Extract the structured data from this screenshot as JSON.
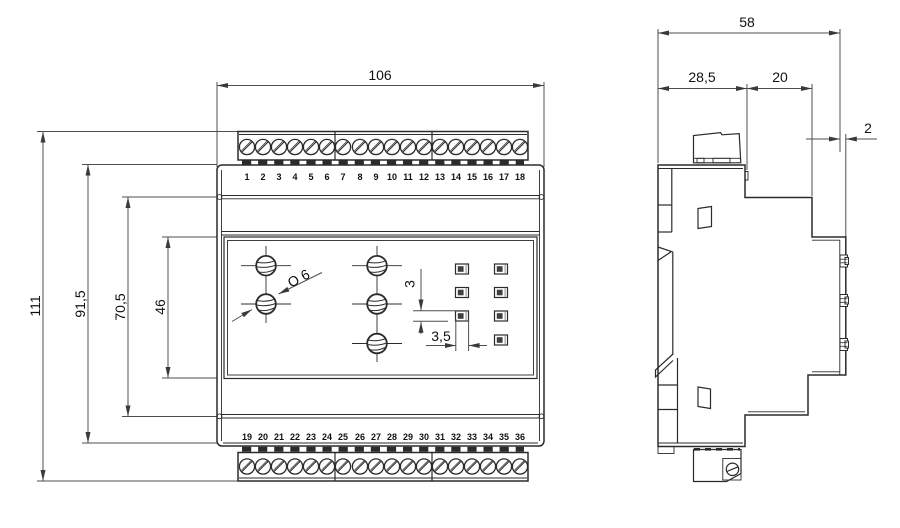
{
  "drawing": {
    "front_view": {
      "width_label": "106",
      "height_labels": {
        "overall": "111",
        "body": "91,5",
        "section": "70,5",
        "panel": "46"
      },
      "annotations": {
        "hole_diameter": "O 6",
        "led_height": "3",
        "led_width": "3,5"
      },
      "top_terminals": [
        "1",
        "2",
        "3",
        "4",
        "5",
        "6",
        "7",
        "8",
        "9",
        "10",
        "11",
        "12",
        "13",
        "14",
        "15",
        "16",
        "17",
        "18"
      ],
      "bottom_terminals": [
        "19",
        "20",
        "21",
        "22",
        "23",
        "24",
        "25",
        "26",
        "27",
        "28",
        "29",
        "30",
        "31",
        "32",
        "33",
        "34",
        "35",
        "36"
      ]
    },
    "side_view": {
      "depth_overall": "58",
      "depth_rear": "28,5",
      "depth_front": "20",
      "panel_lip": "2"
    },
    "colors": {
      "line": "#2b2b2b",
      "dimension": "#4f4f4f",
      "background": "#ffffff"
    }
  }
}
